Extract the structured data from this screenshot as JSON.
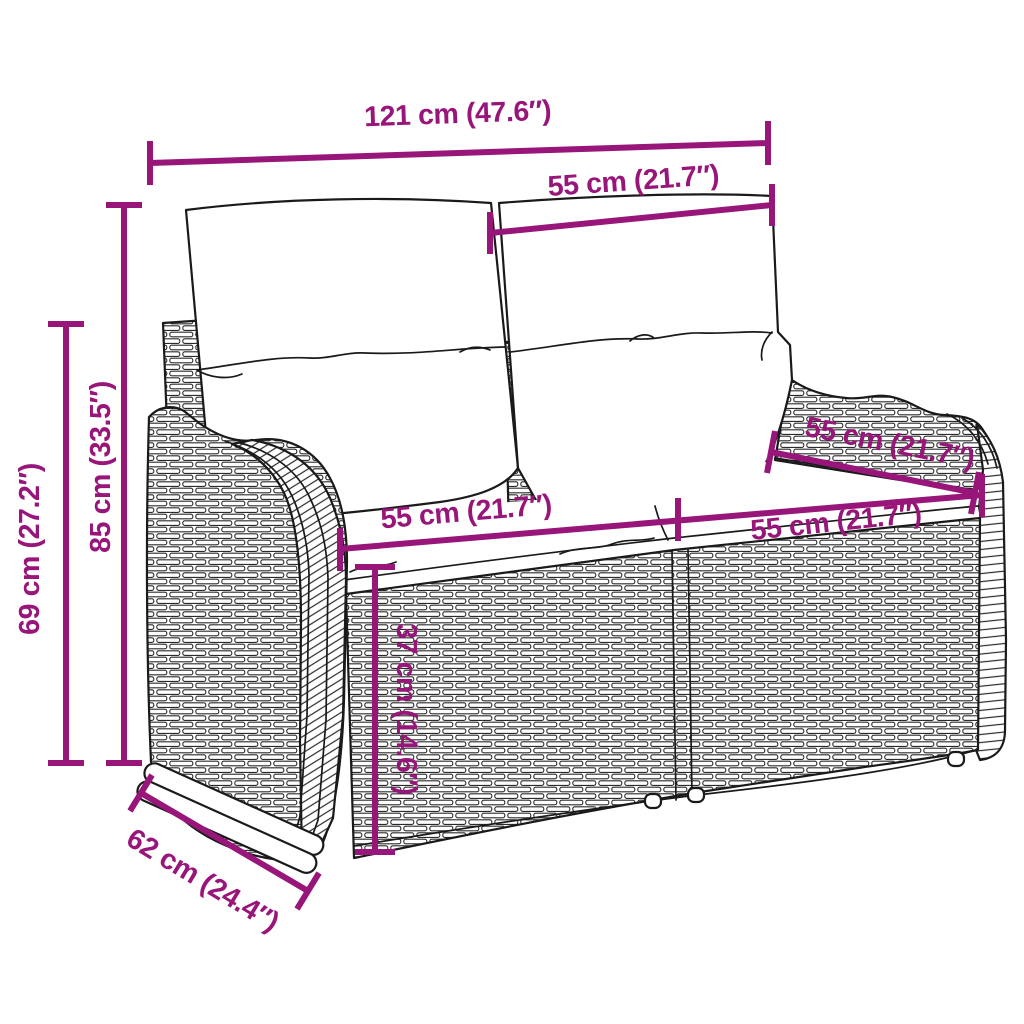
{
  "illustration": {
    "subject": "poly rattan 2-seater garden bench with back cushions and seat cushions, technical dimension drawing",
    "stroke_color": "#1a1a1a",
    "accent_color": "#981579",
    "background_color": "#ffffff"
  },
  "dimensions": {
    "overall_width": {
      "label": "121 cm (47.6″)",
      "value_cm": 121,
      "value_in": 47.6
    },
    "backrest_section_width": {
      "label": "55 cm (21.7″)",
      "value_cm": 55,
      "value_in": 21.7
    },
    "backrest_height": {
      "label": "85 cm (33.5″)",
      "value_cm": 85,
      "value_in": 33.5
    },
    "armrest_height": {
      "label": "69 cm (27.2″)",
      "value_cm": 69,
      "value_in": 27.2
    },
    "seat_width_left": {
      "label": "55 cm (21.7″)",
      "value_cm": 55,
      "value_in": 21.7
    },
    "seat_width_right": {
      "label": "55 cm (21.7″)",
      "value_cm": 55,
      "value_in": 21.7
    },
    "seat_depth": {
      "label": "55 cm (21.7″)",
      "value_cm": 55,
      "value_in": 21.7
    },
    "seat_height": {
      "label": "37 cm (14.6″)",
      "value_cm": 37,
      "value_in": 14.6
    },
    "overall_depth": {
      "label": "62 cm (24.4″)",
      "value_cm": 62,
      "value_in": 24.4
    }
  }
}
